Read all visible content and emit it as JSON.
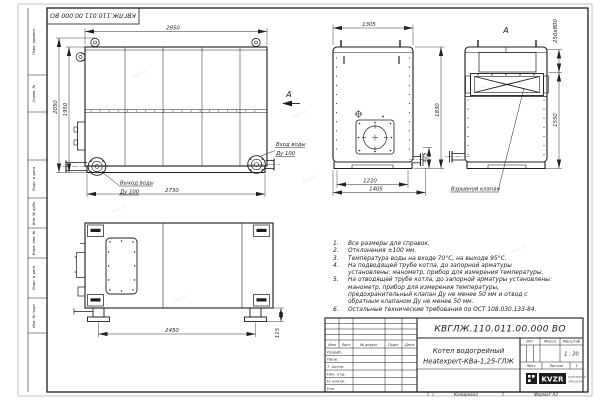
{
  "frame": {
    "top_stamp": "КВГЛЖ.110.011.00.000 ВО",
    "margin_labels": {
      "g1": "Перв. примен.",
      "g2": "Справ. №",
      "g3": "Подп. и дата",
      "g4": "Инв. № дубл.",
      "g5": "Взам. инв. №",
      "g6": "Подп. и дата",
      "g7": "Инв. № подл."
    },
    "bottom": {
      "zone": "1",
      "copied": "Копировал",
      "format": "Формат А3"
    }
  },
  "views": {
    "side": {
      "dim_top": "2850",
      "dim_left_outer": "2050",
      "dim_left_inner": "1950",
      "dim_bottom": "2730",
      "outlet_label": "Выход воды",
      "outlet_dn": "Ду 100",
      "inlet_label": "Вход воды",
      "inlet_dn": "Ду 100",
      "view_arrow": "А"
    },
    "front": {
      "dim_top": "1305",
      "dim_right": "1830",
      "dim_stub": "425",
      "dim_feet": "1220",
      "dim_overall": "1405"
    },
    "rear": {
      "view_label": "А",
      "dim_flue": "250x800",
      "dim_height": "1550",
      "callout": "Взрывной клапан"
    },
    "plan": {
      "dim_legs": "2450",
      "dim_foot": "115"
    }
  },
  "notes": {
    "items": [
      {
        "n": "1.",
        "t": "Все размеры для справок."
      },
      {
        "n": "2.",
        "t": "Отклонения ±100 мм."
      },
      {
        "n": "3.",
        "t": "Температура воды на входе 70°С, на выходе 95°С."
      },
      {
        "n": "4.",
        "t": "На подводящей трубе котла, до запорной арматуры установлены: манометр, прибор для измерения температуры."
      },
      {
        "n": "5.",
        "t": "На отводящей трубе котла, до запорной арматуры установлены: манометр, прибор для измерения температуры, предохранительный клапан Ду не менее 50 мм и отвод с обратным клапаном Ду не менее 50 мм."
      },
      {
        "n": "6.",
        "t": "Остальные технические требования по ОСТ 108.030.133-84."
      }
    ]
  },
  "title_block": {
    "doc_number": "КВГЛЖ.110.011.00.000 ВО",
    "name_line1": "Котел водогрейный",
    "name_line2": "Heatexpert-КВа-1,25-ГЛЖ",
    "col_izm": "Изм",
    "col_list": "Лист",
    "col_doc": "№ докум.",
    "col_sign": "Подп.",
    "col_date": "Дата",
    "row_razrab": "Разраб.",
    "row_prov": "Пров.",
    "row_tkontr": "Т. контр.",
    "row_nachotd": "Нач. отд.",
    "row_nkontr": "Н. контр.",
    "row_utv": "Утв.",
    "h_lit": "Лит.",
    "h_mass": "Масса",
    "h_scale": "Масштаб",
    "scale_value": "1 : 20",
    "sheet_label": "Лист",
    "sheets_label": "Листов",
    "sheets_value": "1",
    "logo_text": "KVZR",
    "logo_caption1": "КОТЕЛЬНЫЙ",
    "logo_caption2": "ЗАВОД РФ"
  },
  "watermark": "kvzr.ru"
}
